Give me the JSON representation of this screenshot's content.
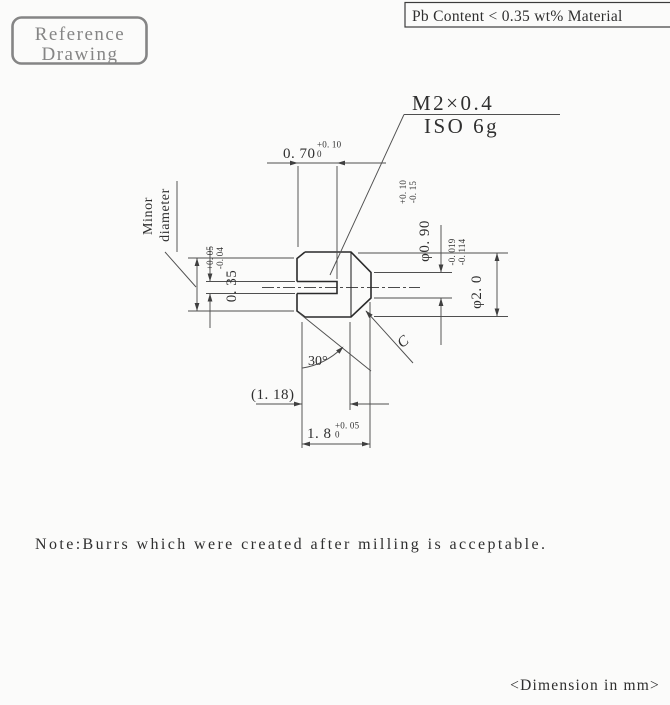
{
  "stamp": {
    "line1": "Reference",
    "line2": "Drawing"
  },
  "material_banner": {
    "text": "Pb Content < 0.35 wt% Material"
  },
  "callout": {
    "thread": "M2×0.4",
    "fit": "ISO 6g"
  },
  "minor_label": {
    "line1": "Minor",
    "line2": "diameter"
  },
  "dims": {
    "slot_depth": {
      "value": "0. 70",
      "tol_upper": "+0. 10",
      "tol_lower": "0"
    },
    "slot_width": {
      "value": "0. 35",
      "tol_upper": "+0. 05",
      "tol_lower": "-0. 04"
    },
    "nose_diameter": {
      "value": "φ0. 90",
      "tol_upper": "+0. 10",
      "tol_lower": "-0. 15"
    },
    "body_diameter": {
      "value": "φ2. 0",
      "tol_upper": "-0. 019",
      "tol_lower": "-0. 114"
    },
    "ref_length": {
      "value": "(1. 18)"
    },
    "overall_length": {
      "value": "1. 8",
      "tol_upper": "+0. 05",
      "tol_lower": "0"
    }
  },
  "angle": {
    "label": "30°"
  },
  "chamfer": {
    "label": "C"
  },
  "note": {
    "text": "Note:Burrs which were created after milling is acceptable."
  },
  "units": {
    "text": "<Dimension in mm>"
  },
  "colors": {
    "line": "#2b2b2b",
    "dim_line": "#4f4f4f",
    "stamp": "#858585",
    "background": "#fbfbfa"
  }
}
